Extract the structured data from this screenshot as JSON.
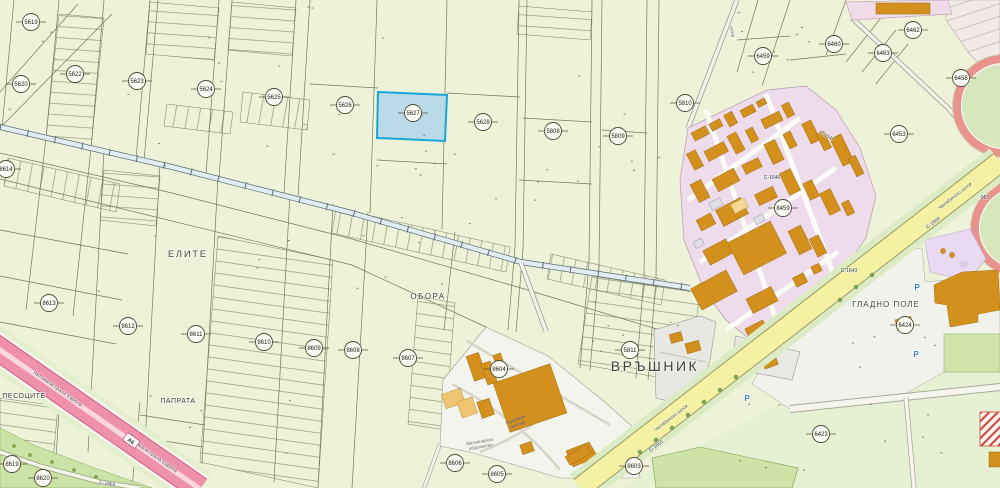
{
  "selected_parcel": {
    "id": "5627",
    "fill": "#b5d7ea",
    "border": "#17a7db"
  },
  "parcels": [
    {
      "id": "5619",
      "x": 31,
      "y": 22
    },
    {
      "id": "5620",
      "x": 21,
      "y": 84
    },
    {
      "id": "5622",
      "x": 75,
      "y": 74
    },
    {
      "id": "5623",
      "x": 137,
      "y": 81
    },
    {
      "id": "5624",
      "x": 206,
      "y": 89
    },
    {
      "id": "5625",
      "x": 274,
      "y": 97
    },
    {
      "id": "5626",
      "x": 345,
      "y": 105
    },
    {
      "id": "5627",
      "x": 413,
      "y": 113
    },
    {
      "id": "5628",
      "x": 483,
      "y": 122
    },
    {
      "id": "5808",
      "x": 553,
      "y": 131
    },
    {
      "id": "5809",
      "x": 618,
      "y": 136
    },
    {
      "id": "5810",
      "x": 685,
      "y": 103
    },
    {
      "id": "6459",
      "x": 763,
      "y": 56
    },
    {
      "id": "6460",
      "x": 834,
      "y": 44
    },
    {
      "id": "6462",
      "x": 913,
      "y": 30
    },
    {
      "id": "6463",
      "x": 883,
      "y": 53
    },
    {
      "id": "6458",
      "x": 961,
      "y": 78
    },
    {
      "id": "6453",
      "x": 899,
      "y": 134
    },
    {
      "id": "8459",
      "x": 783,
      "y": 208
    },
    {
      "id": "6424",
      "x": 905,
      "y": 325
    },
    {
      "id": "6423",
      "x": 821,
      "y": 434
    },
    {
      "id": "8614",
      "x": 6,
      "y": 169
    },
    {
      "id": "8613",
      "x": 49,
      "y": 303
    },
    {
      "id": "8612",
      "x": 128,
      "y": 326
    },
    {
      "id": "8611",
      "x": 196,
      "y": 334
    },
    {
      "id": "8610",
      "x": 264,
      "y": 342
    },
    {
      "id": "8609",
      "x": 314,
      "y": 348
    },
    {
      "id": "8608",
      "x": 353,
      "y": 350
    },
    {
      "id": "8607",
      "x": 408,
      "y": 358
    },
    {
      "id": "5811",
      "x": 630,
      "y": 350
    },
    {
      "id": "8604",
      "x": 499,
      "y": 369
    },
    {
      "id": "8606",
      "x": 455,
      "y": 463
    },
    {
      "id": "8605",
      "x": 497,
      "y": 474
    },
    {
      "id": "8603",
      "x": 634,
      "y": 466
    },
    {
      "id": "8619",
      "x": 12,
      "y": 464
    },
    {
      "id": "8620",
      "x": 43,
      "y": 478
    }
  ],
  "area_labels": [
    {
      "text": "ЕЛИТЕ",
      "x": 188,
      "y": 257,
      "size": 9,
      "ls": 2
    },
    {
      "text": "ОБОРА",
      "x": 428,
      "y": 299,
      "size": 8,
      "ls": 1.5
    },
    {
      "text": "ВРЪШНИК",
      "x": 655,
      "y": 371,
      "size": 14,
      "ls": 2.5
    },
    {
      "text": "ГЛАДНО ПОЛЕ",
      "x": 886,
      "y": 307,
      "size": 8,
      "ls": 1
    },
    {
      "text": "ПЕСОЦИТЕ",
      "x": 24,
      "y": 398,
      "size": 7,
      "ls": 0.5
    },
    {
      "text": "ПАПРАТА",
      "x": 178,
      "y": 403,
      "size": 7,
      "ls": 0.5
    }
  ],
  "road_labels": [
    {
      "text": "Челябинско шосе",
      "x": 672,
      "y": 419,
      "angle": -38,
      "size": 5,
      "color": "#55573f"
    },
    {
      "text": "Челябинско шосе",
      "x": 956,
      "y": 197,
      "angle": -38,
      "size": 5,
      "color": "#55573f"
    },
    {
      "text": "С-1904",
      "x": 934,
      "y": 224,
      "angle": -38,
      "size": 5,
      "color": "#2e3e4e"
    },
    {
      "text": "957",
      "x": 985,
      "y": 199,
      "angle": 0,
      "size": 5,
      "color": "#2e3e4e"
    },
    {
      "text": "С-1647",
      "x": 826,
      "y": 137,
      "angle": 28,
      "size": 5,
      "color": "#2e3e4e"
    },
    {
      "text": "С-1646",
      "x": 772,
      "y": 179,
      "angle": 0,
      "size": 5,
      "color": "#2e3e4e"
    },
    {
      "text": "С-1643",
      "x": 849,
      "y": 272,
      "angle": 0,
      "size": 5,
      "color": "#2e3e4e"
    },
    {
      "text": "С-1661",
      "x": 657,
      "y": 447,
      "angle": -38,
      "size": 5,
      "color": "#2e3e4e"
    },
    {
      "text": "С-1865",
      "x": 107,
      "y": 485,
      "angle": 10,
      "size": 5,
      "color": "#2e3e4e"
    },
    {
      "text": "Автомагистрала Европа",
      "x": 57,
      "y": 390,
      "angle": 35,
      "size": 5.2,
      "color": "#5a3f4c"
    },
    {
      "text": "Автомагистрала Европа",
      "x": 152,
      "y": 456,
      "angle": 35,
      "size": 5.2,
      "color": "#5a3f4c"
    },
    {
      "text": "шосе",
      "x": 731,
      "y": 32,
      "angle": 82,
      "size": 4.5,
      "color": "#3e5468"
    }
  ],
  "highway_badge": {
    "text": "А6",
    "x": 131,
    "y": 441,
    "angle": 35
  },
  "pois": [
    {
      "lines": [
        "Митничарско",
        "общежитие"
      ],
      "x": 480,
      "y": 443,
      "size": 4.6,
      "color": "#73736a",
      "angle": -10
    },
    {
      "lines": [
        "търговски",
        "център"
      ],
      "x": 516,
      "y": 421,
      "size": 4.6,
      "color": "#4a62a8",
      "angle": -20
    }
  ],
  "parking_icons": [
    {
      "glyph": "P",
      "x": 917,
      "y": 290
    },
    {
      "glyph": "P",
      "x": 916,
      "y": 357
    },
    {
      "glyph": "P",
      "x": 747,
      "y": 401
    }
  ],
  "colors": {
    "parcel_base": "#edf2d8",
    "industrial_zone": "#eedcec",
    "building": "#d3901d",
    "highway": "#ee8fa8",
    "main_road": "#f5f1a3",
    "selection_fill": "#b5d7ea",
    "selection_border": "#17a7db"
  }
}
